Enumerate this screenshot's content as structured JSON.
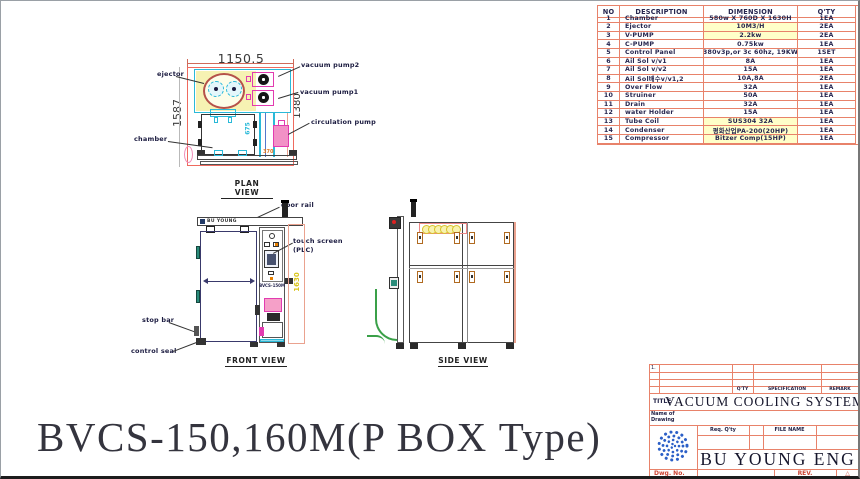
{
  "main_title": "BVCS-150,160M(P BOX Type)",
  "parts_table": {
    "headers": {
      "no": "NO",
      "description": "DESCRIPTION",
      "dimension": "DIMENSION",
      "qty": "Q'TY"
    },
    "rows": [
      {
        "no": "1",
        "description": "Chamber",
        "dimension": "580w X 760D X 1630H",
        "qty": "1EA"
      },
      {
        "no": "2",
        "description": "Ejector",
        "dimension": "10M3/H",
        "qty": "2EA"
      },
      {
        "no": "3",
        "description": "V-PUMP",
        "dimension": "2.2kw",
        "qty": "2EA"
      },
      {
        "no": "4",
        "description": "C-PUMP",
        "dimension": "0.75kw",
        "qty": "1EA"
      },
      {
        "no": "5",
        "description": "Control Panel",
        "dimension": "380v3p,or 3c 60hz, 19KW",
        "qty": "1SET"
      },
      {
        "no": "6",
        "description": "Ail Sol v/v1",
        "dimension": "8A",
        "qty": "1EA"
      },
      {
        "no": "7",
        "description": "Ail Sol v/v2",
        "dimension": "15A",
        "qty": "1EA"
      },
      {
        "no": "8",
        "description": "Ail Sol배수v/v1,2",
        "dimension": "10A,8A",
        "qty": "2EA"
      },
      {
        "no": "9",
        "description": "Over Flow",
        "dimension": "32A",
        "qty": "1EA"
      },
      {
        "no": "10",
        "description": "Struiner",
        "dimension": "50A",
        "qty": "1EA"
      },
      {
        "no": "11",
        "description": "Drain",
        "dimension": "32A",
        "qty": "1EA"
      },
      {
        "no": "12",
        "description": "water Holder",
        "dimension": "15A",
        "qty": "1EA"
      },
      {
        "no": "13",
        "description": "Tube Coil",
        "dimension": "SUS304 32A",
        "qty": "1EA"
      },
      {
        "no": "14",
        "description": "Condenser",
        "dimension": "평화산업PA-200(20HP)",
        "qty": "1EA"
      },
      {
        "no": "15",
        "description": "Compressor",
        "dimension": "Bitzer Comp(15HP)",
        "qty": "1EA"
      }
    ]
  },
  "plan_view": {
    "caption": "PLAN VIEW",
    "dim_width": "1150.5",
    "dim_depth_left": "1587",
    "dim_depth_right": "1380",
    "dim_inner": "675",
    "dim_rail": "370",
    "label_ejector": "ejector",
    "label_vacuum_pump2": "vacuum pump2",
    "label_vacuum_pump1": "vacuum pump1",
    "label_circulation_pump": "circulation pump",
    "label_chamber": "chamber"
  },
  "front_view": {
    "caption": "FRONT VIEW",
    "brand": "BU YOUNG",
    "model": "BVCS-150M",
    "dim_height": "1630",
    "label_door_rail": "door rail",
    "label_touch_screen": "touch screen",
    "label_plc": "(PLC)",
    "label_stop_bar": "stop bar",
    "label_control_seal": "control seal"
  },
  "side_view": {
    "caption": "SIDE VIEW"
  },
  "title_block": {
    "item_no": "1.",
    "qty_header": "Q'TY",
    "spec_header": "SPECIFICATION",
    "remark_header": "REMARK",
    "title_label": "TITLE",
    "title": "VACUUM COOLING SYSTEM",
    "name_of_drawing": "Name of Drawing",
    "req_qty": "Req. Q'ty",
    "file_name": "FILE NAME",
    "company": "BU YOUNG ENG",
    "dwg_no": "Dwg. No.",
    "rev": "REV.",
    "warn": "△"
  },
  "colors": {
    "grid": "#e8826a",
    "cyan": "#2ab9d8",
    "magenta": "#e23bb0",
    "red": "#ef6a5e",
    "yellow_fill": "#f6f2b3",
    "navy": "#1b1b40",
    "logo_blue": "#2b5fc7"
  }
}
